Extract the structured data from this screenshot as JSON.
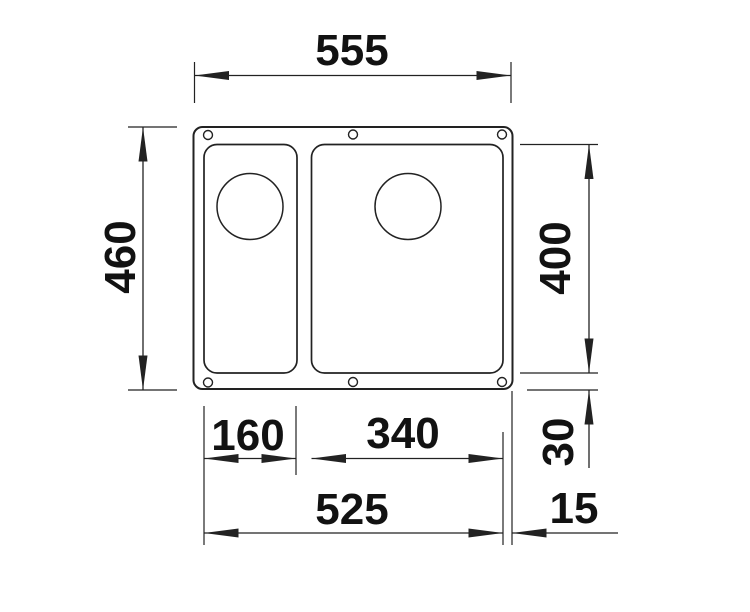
{
  "page": {
    "background": "#ffffff"
  },
  "drawing": {
    "type": "technical-dimension-drawing",
    "subject": "double-bowl undermount sink, top view with outer contour, two bowls, drain circles and six mounting holes",
    "line_color": "#222222",
    "text_color": "#121212",
    "dims": {
      "overall_width": "555",
      "overall_depth": "460",
      "bowl_depth": "400",
      "bottom_offset": "30",
      "small_bowl_width": "160",
      "large_bowl_width": "340",
      "bowls_outer_span": "525",
      "right_offset": "15"
    }
  }
}
